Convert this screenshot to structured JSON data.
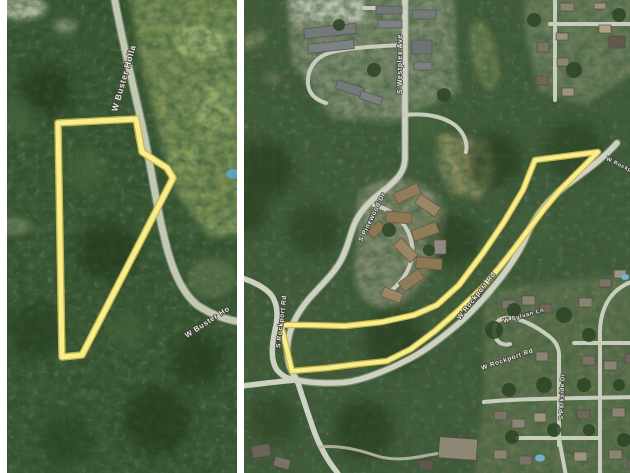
{
  "collage": {
    "divider_color": "#ffffff",
    "parcel_color": "#f7ef8e",
    "parcel_casing_color": "#cdb44c"
  },
  "left_map": {
    "parcel_points": "51,123 129,119 135,152 160,168 166,178 75,355 55,357",
    "labels": {
      "road_top": "W Buster Holla",
      "road_bottom": "W Buster Ho"
    }
  },
  "right_map": {
    "parcel_points": "354,152 291,160 279,190 260,222 239,253 215,285 193,305 170,315 138,322 101,326 63,325 37,325 48,371 83,368 115,364 143,361 167,349 191,331 215,310 237,289 255,268 270,249 285,229 300,209 315,191 330,176 343,163",
    "labels": {
      "street_westplex": "S Westplex Ave",
      "road_winding": "S Pinewood Dr",
      "rockport_left": "S Rockport Rd",
      "rockport_mid": "W Rockport Rd",
      "rockport_bottom": "W Rockport Rd",
      "rockport_corner": "W Rockport Rd",
      "street_sylvan": "W Sylvan Ln",
      "street_parkside": "S Parkside Dr"
    }
  }
}
